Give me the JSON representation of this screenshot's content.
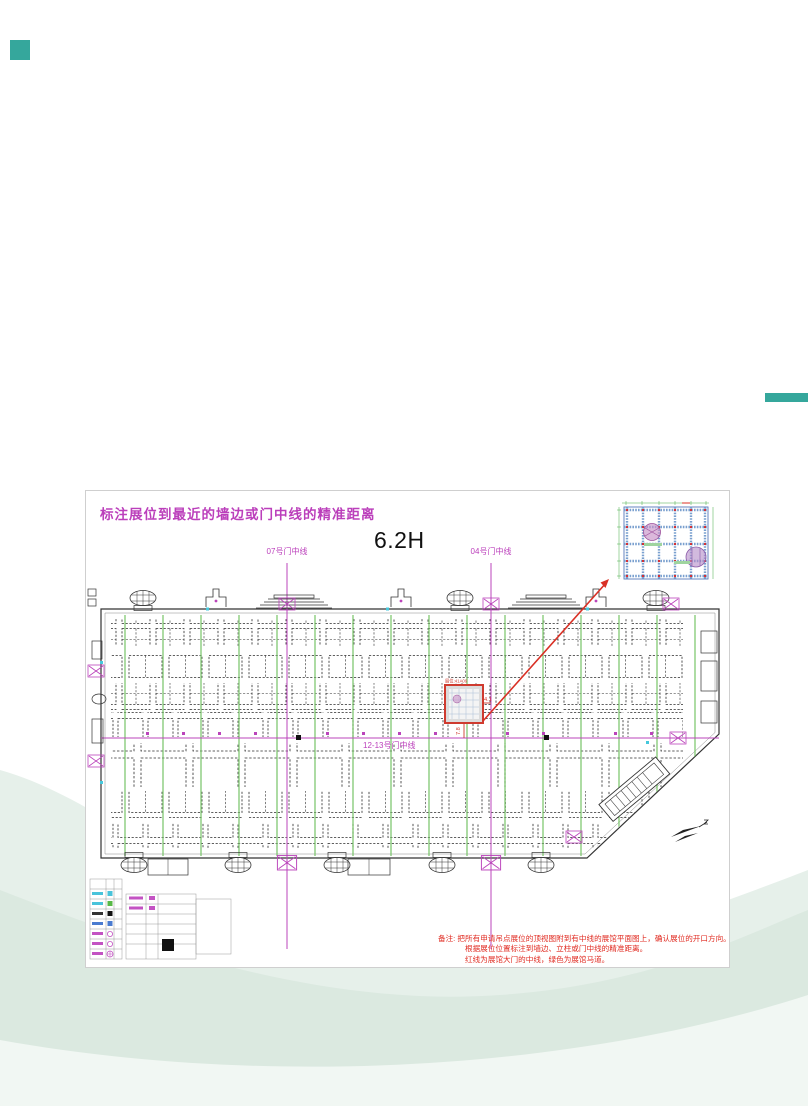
{
  "decor": {
    "accent_teal": "#35a79c"
  },
  "plan": {
    "title": "标注展位到最近的墙边或门中线的精准距离",
    "hall_height_label": "6.2H",
    "door07_label": "07号门中线",
    "door04_label": "04号门中线",
    "door1213_label": "12-13号门中线",
    "booth_tag": "展位:41A09",
    "dist_to_door04": "4.1",
    "dist_to_door1213": "7.8",
    "notes": {
      "line1": "备注: 把所有申请吊点展位的顶视图附到有中线的展馆平面图上，确认展位的开口方向。",
      "line2": "根据展位位置标注到墙边、立柱或门中线的精准距离。",
      "line3": "红线为展馆大门的中线，绿色为展馆马道。"
    },
    "colors": {
      "centerline": "#bb44bb",
      "catwalk": "#76c466",
      "highlight": "#d93025"
    }
  }
}
